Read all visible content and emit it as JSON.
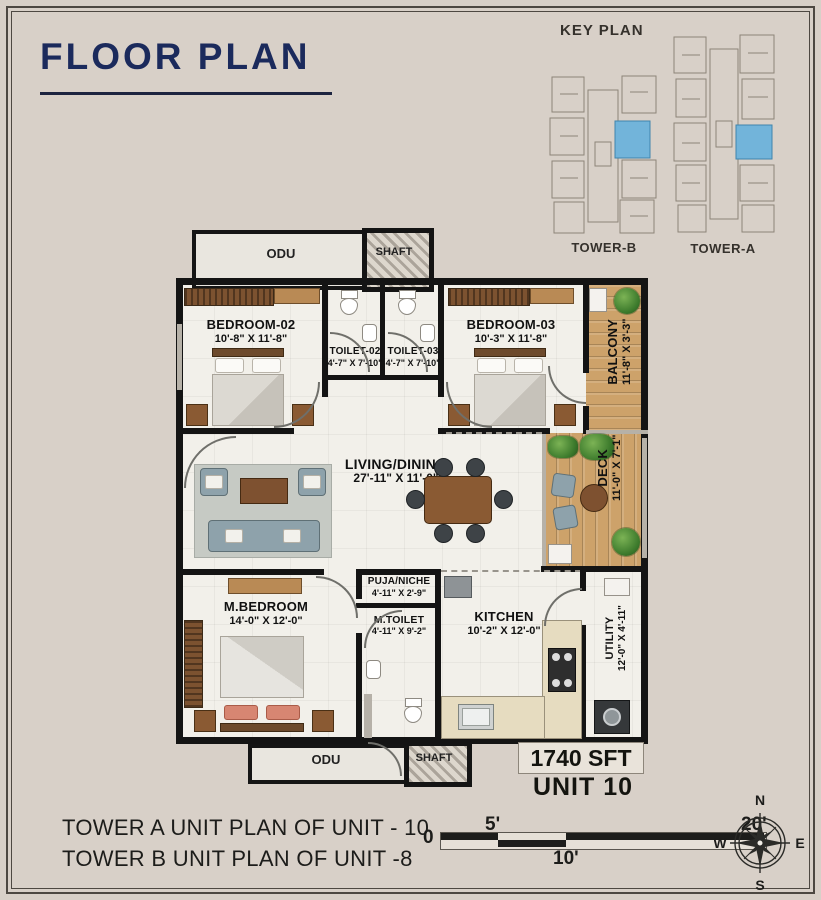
{
  "page": {
    "title": "FLOOR PLAN"
  },
  "key_plan": {
    "title": "KEY PLAN",
    "tower_b_label": "TOWER-B",
    "tower_a_label": "TOWER-A",
    "highlight_color": "#72b4da"
  },
  "rooms": {
    "odu_top": {
      "name": "ODU"
    },
    "shaft_top": {
      "name": "SHAFT"
    },
    "bedroom2": {
      "name": "BEDROOM-02",
      "dims": "10'-8\" X 11'-8\""
    },
    "toilet2": {
      "name": "TOILET-02",
      "dims": "4'-7\" X 7'-10\""
    },
    "toilet3": {
      "name": "TOILET-03",
      "dims": "4'-7\" X 7'-10\""
    },
    "bedroom3": {
      "name": "BEDROOM-03",
      "dims": "10'-3\" X 11'-8\""
    },
    "balcony": {
      "name": "BALCONY",
      "dims": "11'-8\" X 3'-3\""
    },
    "living": {
      "name": "LIVING/DINING",
      "dims": "27'-11\" X 11'-0\""
    },
    "deck": {
      "name": "DECK",
      "dims": "11'-0\" X 7'-1\""
    },
    "mbedroom": {
      "name": "M.BEDROOM",
      "dims": "14'-0\" X 12'-0\""
    },
    "puja": {
      "name": "PUJA/NICHE",
      "dims": "4'-11\" X 2'-9\""
    },
    "mtoilet": {
      "name": "M.TOILET",
      "dims": "4'-11\" X 9'-2\""
    },
    "kitchen": {
      "name": "KITCHEN",
      "dims": "10'-2\" X 12'-0\""
    },
    "utility": {
      "name": "UTILITY",
      "dims": "12'-0\" X 4'-11\""
    },
    "odu_bottom": {
      "name": "ODU"
    },
    "shaft_bottom": {
      "name": "SHAFT"
    }
  },
  "unit_info": {
    "area": "1740 SFT",
    "unit": "UNIT 10"
  },
  "captions": {
    "line1": "TOWER A UNIT PLAN OF UNIT - 10",
    "line2": "TOWER B UNIT PLAN OF UNIT -8"
  },
  "scale_bar": {
    "zero": "0",
    "five": "5'",
    "ten": "10'",
    "twenty": "20'"
  },
  "compass": {
    "n": "N",
    "e": "E",
    "s": "S",
    "w": "W"
  }
}
